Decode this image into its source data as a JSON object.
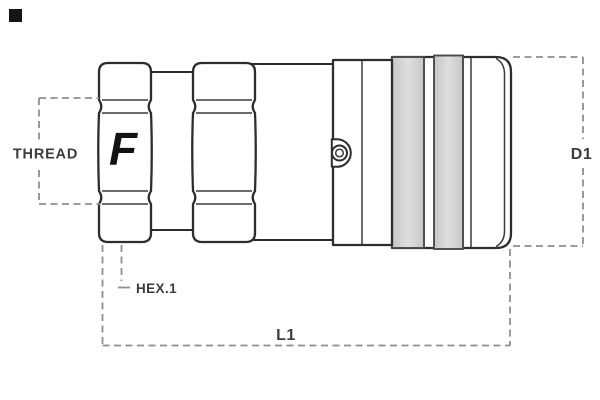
{
  "diagram": {
    "type": "technical-drawing",
    "subject": "quick-release-coupling-side-view",
    "logo_letter": "F",
    "dimension_labels": {
      "thread": "THREAD",
      "hex": "HEX.1",
      "length": "L1",
      "diameter": "D1"
    },
    "colors": {
      "outline": "#2d2d2d",
      "dimension_line": "#8f8f8f",
      "label_text": "#3d3d3d",
      "sleeve_band_fill": "#d8d8d8",
      "sleeve_band_edge": "#4a4a4a",
      "logo": "#121212",
      "corner_marker": "#161616",
      "background": "#ffffff"
    }
  }
}
